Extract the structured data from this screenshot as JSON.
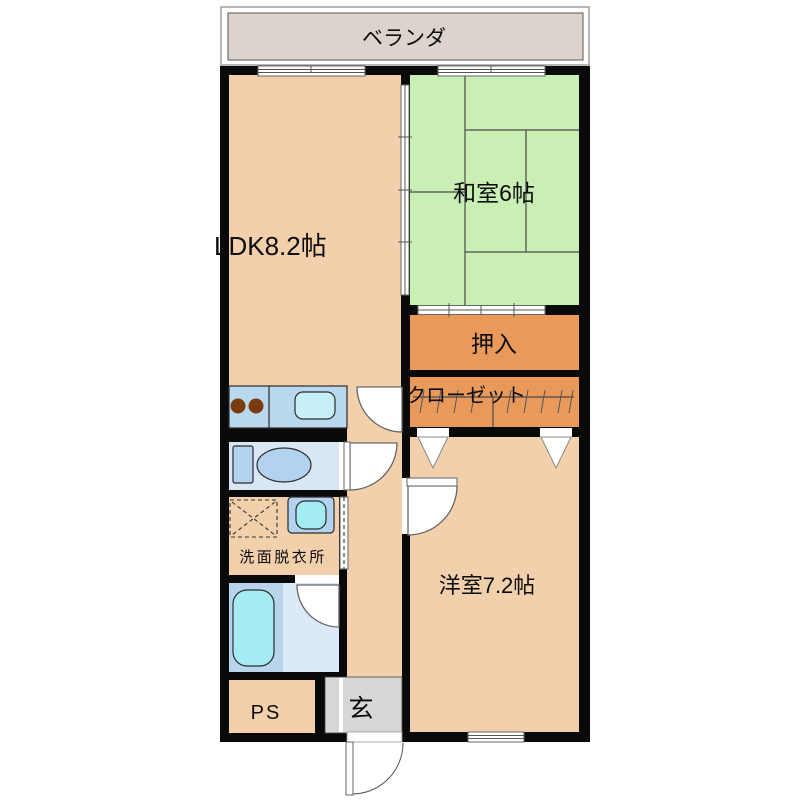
{
  "floorplan": {
    "labels": {
      "veranda": "ベランダ",
      "washitsu": "和室6帖",
      "ldk": "LDK8.2帖",
      "oshiire": "押入",
      "closet": "クローゼット",
      "yoshitsu": "洋室7.2帖",
      "senmen": "洗面脱衣所",
      "ps": "PS",
      "genkan": "玄"
    },
    "colors": {
      "wall": "#0a0a0a",
      "room_peach": "#f3d0ac",
      "tatami_green": "#c9efb4",
      "storage_orange": "#e9995a",
      "veranda_gray": "#dcd3cc",
      "entrance_gray": "#d7d7d7",
      "wet_floor_blue": "#d9e6f6",
      "bath_floor_blue": "#b9d5eb",
      "bath_floor_light": "#dce9f7",
      "counter_blue": "#b9d8ee",
      "fixture_blue": "#b3d2ef",
      "sink_cyan": "#c6eff8",
      "tub_cyan": "#a5ebf3",
      "burner_brown": "#7a3c0f",
      "ps_text_gray": "#7b766c",
      "canvas_white": "#ffffff"
    }
  }
}
